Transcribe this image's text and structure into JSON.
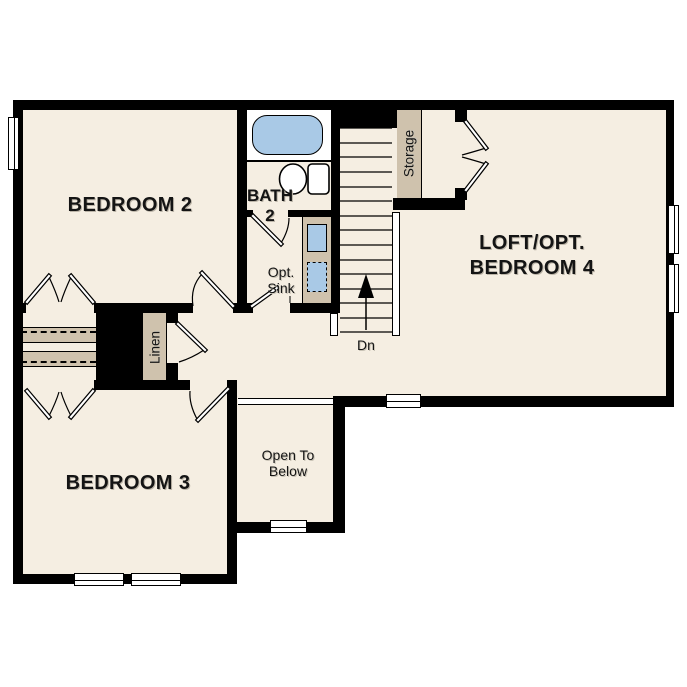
{
  "floorplan": {
    "rooms": [
      {
        "id": "bedroom-2",
        "lines": [
          "BEDROOM 2"
        ]
      },
      {
        "id": "bath-2",
        "lines": [
          "BATH",
          "2"
        ]
      },
      {
        "id": "loft-opt-bedroom-4",
        "lines": [
          "LOFT/OPT.",
          "BEDROOM 4"
        ]
      },
      {
        "id": "bedroom-3",
        "lines": [
          "BEDROOM 3"
        ]
      },
      {
        "id": "open-to-below",
        "lines": [
          "Open To",
          "Below"
        ]
      }
    ],
    "closets": {
      "linen": "Linen",
      "storage": "Storage"
    },
    "stairs": {
      "direction_label": "Dn"
    },
    "bath": {
      "optional_sink_lines": [
        "Opt.",
        "Sink"
      ]
    },
    "colors": {
      "floor": "#f5eee2",
      "outside": "#ffffff",
      "wall": "#000000",
      "casework": "#cfc2ad",
      "plumbing_fixture": "#a9c9e6"
    }
  }
}
